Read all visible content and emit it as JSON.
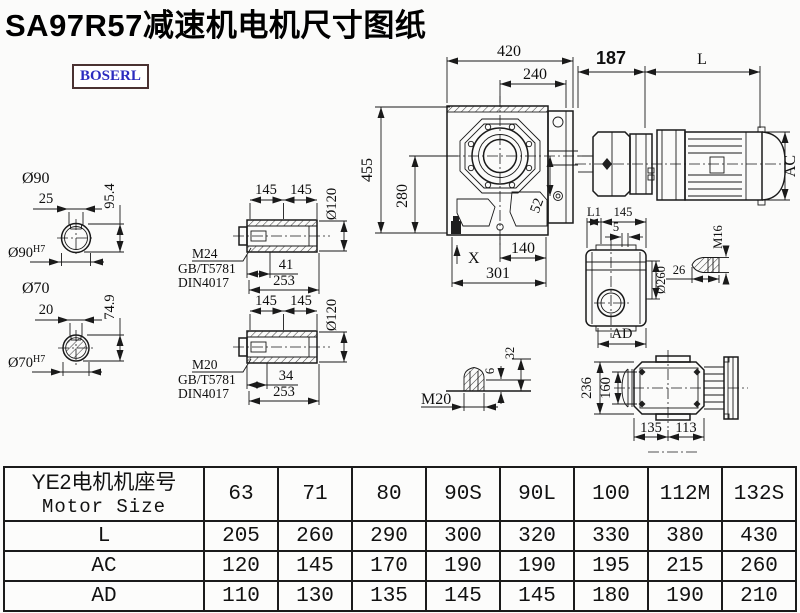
{
  "title": "SA97R57减速机电机尺寸图纸",
  "logo": "BOSERL",
  "front_view": {
    "w420": "420",
    "w240": "240",
    "h455": "455",
    "h280": "280",
    "d52": "52",
    "w140": "140",
    "w301": "301",
    "x_mark": "X"
  },
  "motor_view": {
    "d187": "187",
    "dL": "L",
    "dAC": "AC"
  },
  "top_view": {
    "dL1": "L1",
    "d145": "145",
    "d5": "5",
    "d260": "Ø260",
    "dAD": "AD"
  },
  "bolt_m16": {
    "thread": "M16",
    "len": "26"
  },
  "bolt_m20": {
    "thread": "M20",
    "d6": "6",
    "d32": "32"
  },
  "rear_view": {
    "d236": "236",
    "d160": "160",
    "d135": "135",
    "d113": "113"
  },
  "shaft_a": {
    "dia": "Ø90",
    "key": "25",
    "height": "95.4",
    "bore": "Ø90",
    "fit": "H7"
  },
  "shaft_b": {
    "dia": "Ø70",
    "key": "20",
    "height": "74.9",
    "bore": "Ø70",
    "fit": "H7"
  },
  "detail_a": {
    "seg1": "145",
    "seg2": "145",
    "dia": "Ø120",
    "thread": "M24",
    "std1": "GB/T5781",
    "std2": "DIN4017",
    "len1": "41",
    "len2": "253"
  },
  "detail_b": {
    "seg1": "145",
    "seg2": "145",
    "dia": "Ø120",
    "thread": "M20",
    "std1": "GB/T5781",
    "std2": "DIN4017",
    "len1": "34",
    "len2": "253"
  },
  "table": {
    "header_cn": "YE2电机机座号",
    "header_en": "Motor Size",
    "columns": [
      "63",
      "71",
      "80",
      "90S",
      "90L",
      "100",
      "112M",
      "132S"
    ],
    "rows": [
      {
        "label": "L",
        "values": [
          "205",
          "260",
          "290",
          "300",
          "320",
          "330",
          "380",
          "430"
        ]
      },
      {
        "label": "AC",
        "values": [
          "120",
          "145",
          "170",
          "190",
          "190",
          "195",
          "215",
          "260"
        ]
      },
      {
        "label": "AD",
        "values": [
          "110",
          "130",
          "135",
          "145",
          "145",
          "180",
          "190",
          "210"
        ]
      }
    ]
  },
  "colors": {
    "line": "#1a1a1a",
    "logo_text": "#2b2bbf",
    "logo_border": "#4a3232"
  }
}
